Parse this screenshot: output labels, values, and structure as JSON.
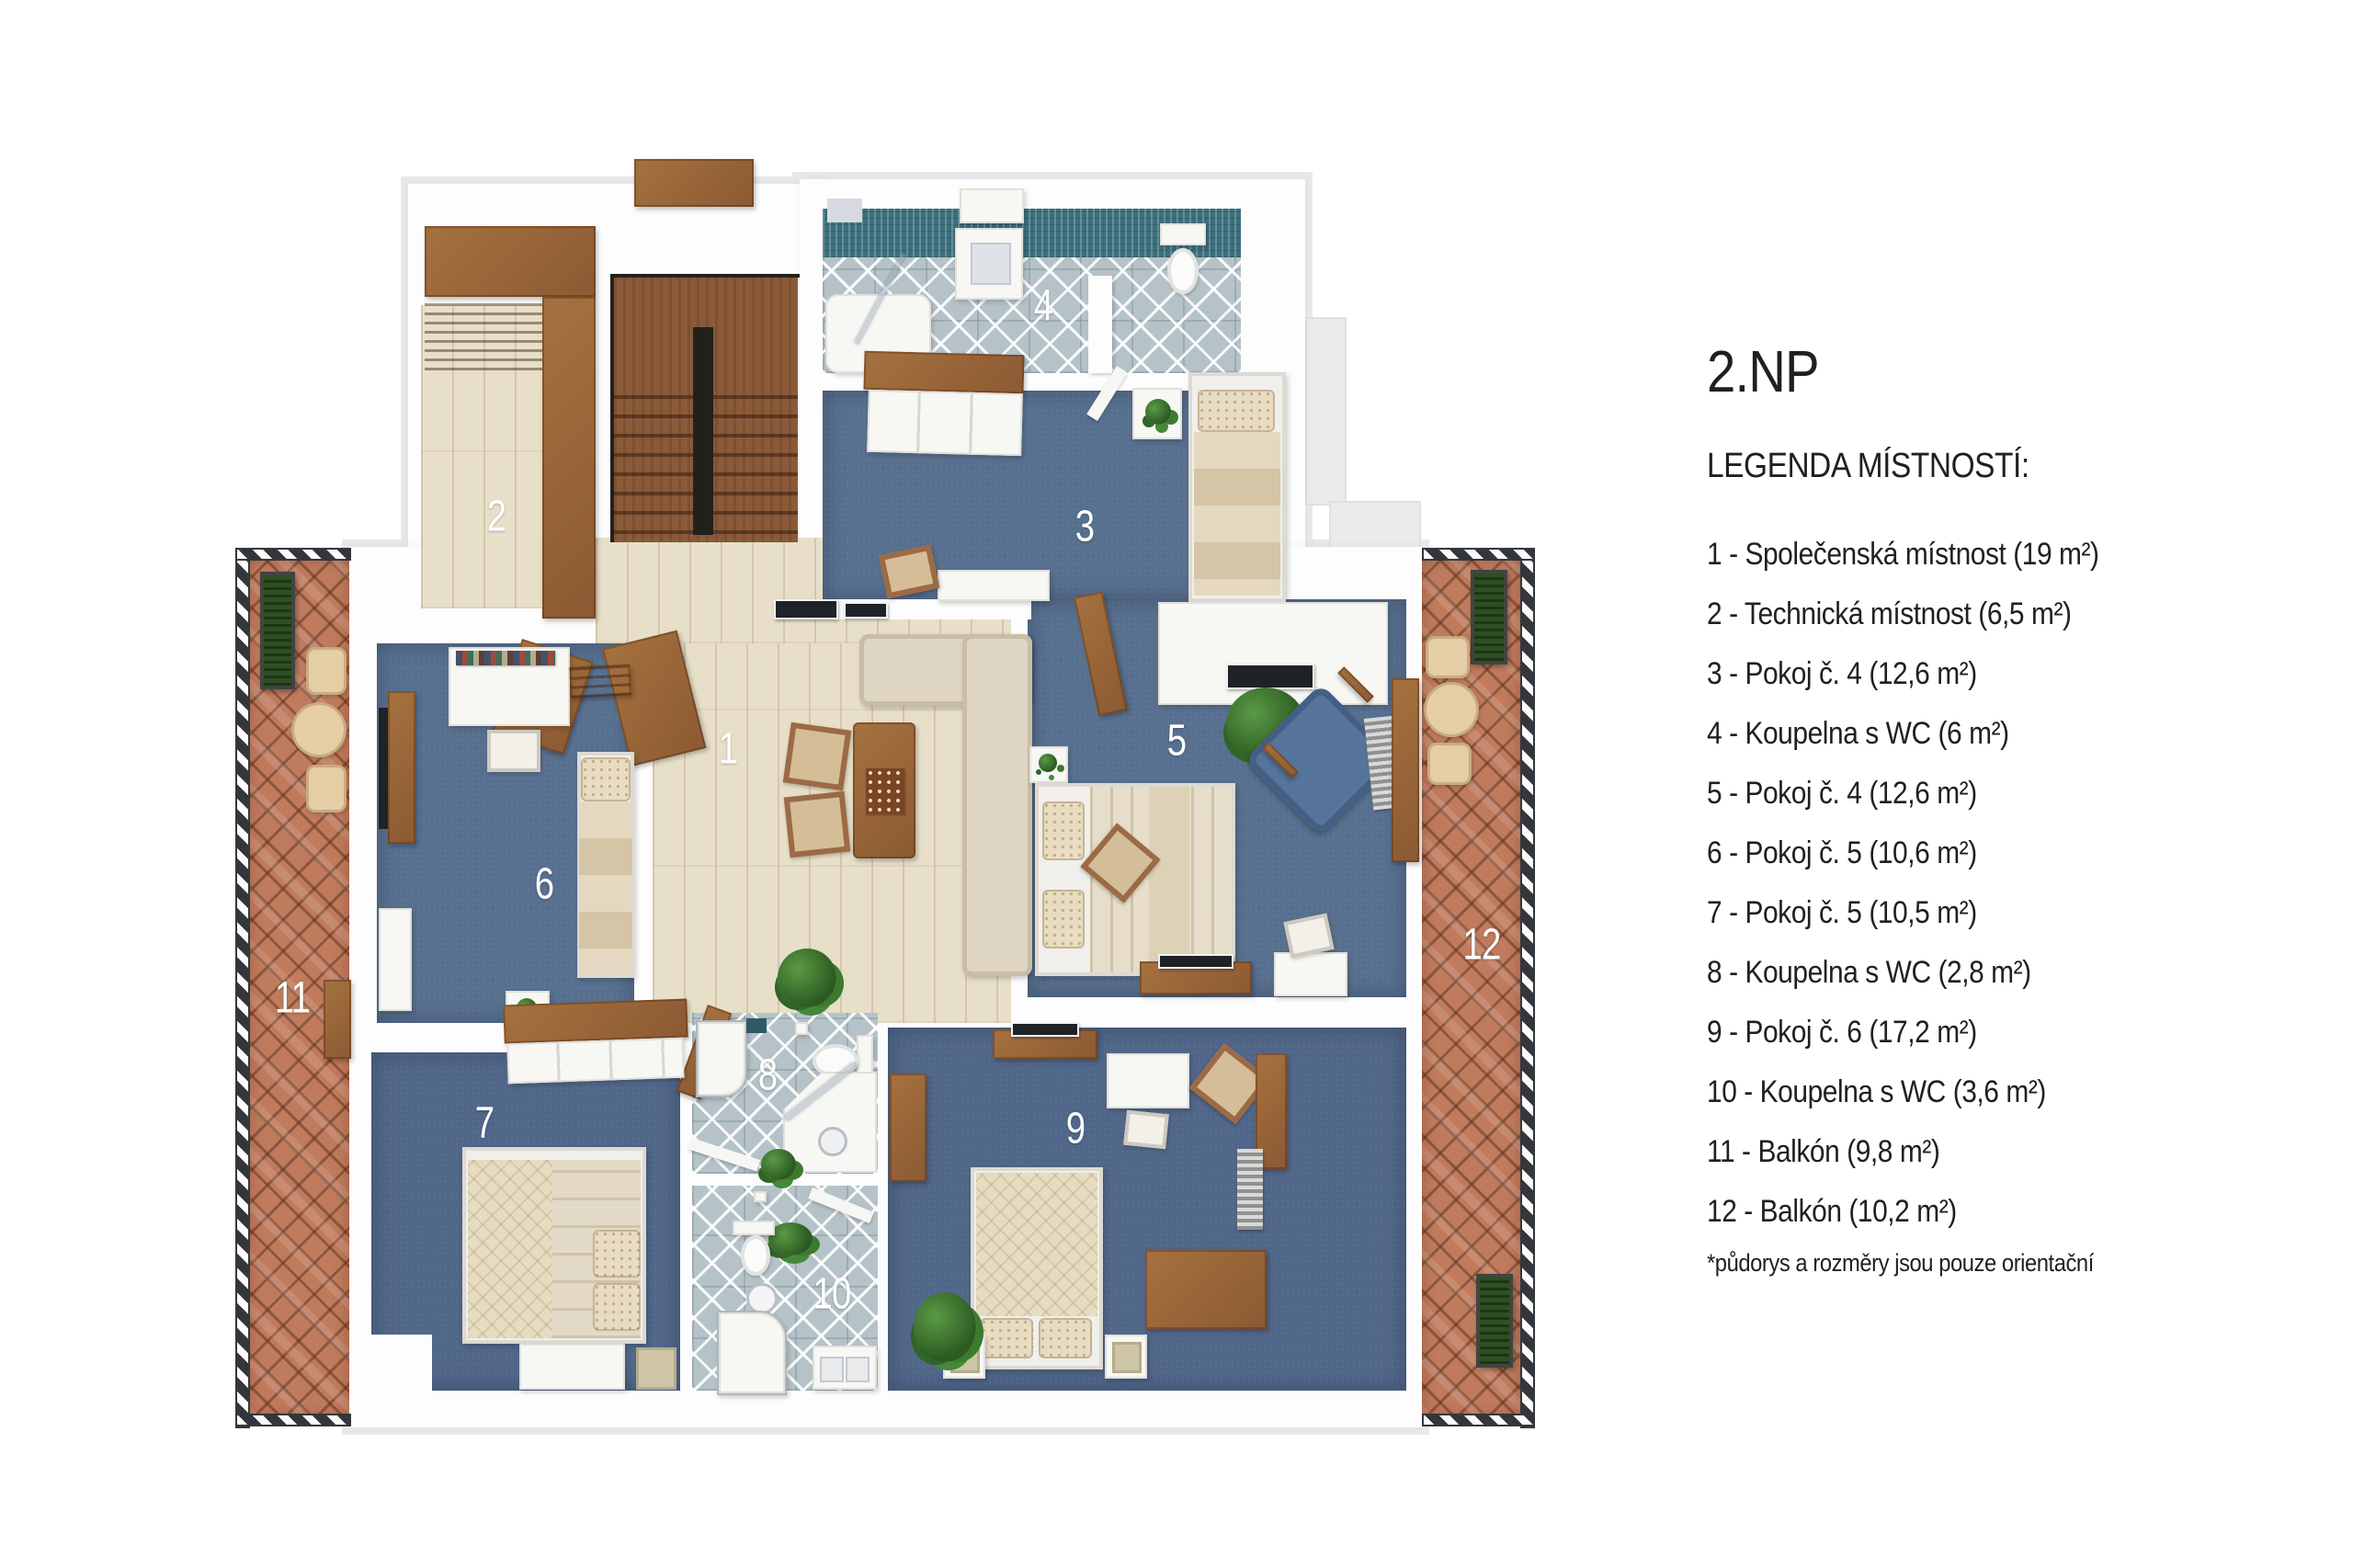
{
  "title": "2.NP",
  "legend": {
    "heading": "LEGENDA MÍSTNOSTÍ:",
    "items": [
      "1 - Společenská místnost (19 m²)",
      "2 - Technická místnost (6,5 m²)",
      "3 - Pokoj č. 4 (12,6 m²)",
      "4 - Koupelna s WC (6 m²)",
      "5 - Pokoj č. 4 (12,6 m²)",
      "6 - Pokoj č. 5 (10,6 m²)",
      "7 - Pokoj č. 5 (10,5 m²)",
      "8 - Koupelna s WC (2,8 m²)",
      "9 - Pokoj č. 6 (17,2 m²)",
      "10 - Koupelna s WC (3,6 m²)",
      "11 - Balkón (9,8 m²)",
      "12 - Balkón (10,2 m²)"
    ],
    "footnote": "*půdorys a rozměry jsou pouze orientační"
  },
  "plan": {
    "room_labels": [
      "1",
      "2",
      "3",
      "4",
      "5",
      "6",
      "7",
      "8",
      "9",
      "10",
      "11",
      "12"
    ]
  },
  "colors": {
    "background": "#ffffff",
    "carpet": "#58708f",
    "carpet_dark": "#516789",
    "wood_floor": "#e8dfc9",
    "stair_wood": "#8a5a39",
    "furniture_wood": "#9c6a45",
    "beech": "#e5cda6",
    "tile_base": "#b5c3c9",
    "teal_band": "#3b6f7d",
    "terracotta": "#c07b5d",
    "railing": "#33373c",
    "linen": "#e6deca",
    "denim": "#56749c",
    "plant_green": "#3f7b33",
    "label_text": "#ffffff",
    "legend_text": "#202020"
  }
}
